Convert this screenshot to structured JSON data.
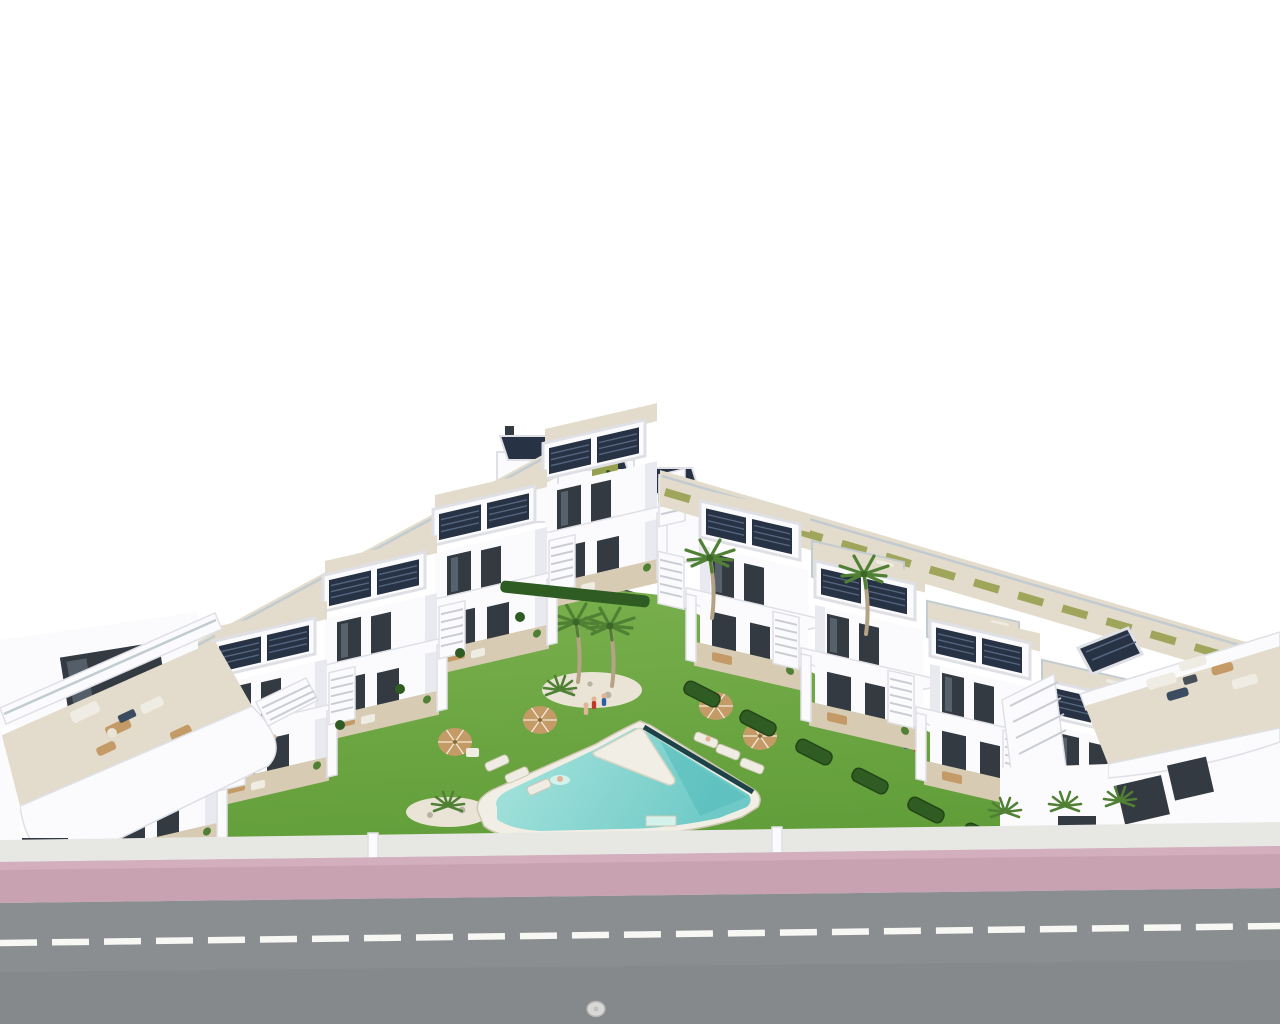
{
  "meta": {
    "title": "Aerial 3D architectural render of a white residential complex with communal pool and garden",
    "type": "3d-exterior-render",
    "canvas": {
      "width": 1280,
      "height": 1024
    }
  },
  "palette": {
    "sky": "#ffffff",
    "white": "#fbfbfd",
    "shade": "#e9eaef",
    "shade2": "#d9dade",
    "outline": "#dfe0e6",
    "window": "#343a42",
    "glass": "#73828f",
    "solar": "#273244",
    "solarline": "#55657f",
    "deck": "#e3dccc",
    "deckline": "#cfc6b2",
    "wood": "#d8cbb4",
    "tan": "#c49a66",
    "sofa": "#efece4",
    "navy": "#3c4c60",
    "lawn_light": "#7cb24f",
    "lawn_dark": "#5f9c38",
    "hedge": "#2f5c22",
    "olive": "#97a050",
    "palm": "#4f8034",
    "trunk": "#b5a386",
    "rock": "#e9e4d6",
    "rockdot": "#b9b3a4",
    "pooldeck": "#f1eee5",
    "water_light": "#a9e4dd",
    "water_mid": "#6fcac7",
    "water3": "#52bcba",
    "edge": "#1d4247",
    "splash": "#d4f2ec",
    "wall": "#e7e7e4",
    "pink": "#c9a2b2",
    "pink2": "#d6b3c1",
    "road": "#8b8e90",
    "roaddark": "#7f8284",
    "lane": "#f7f7f4",
    "skin": "#e2b394",
    "red": "#c0392b",
    "blue": "#2e5fa3",
    "stepline": "#c9ccd3",
    "glassline": "#c2cbd0",
    "table": "#474f58",
    "manhole": "#d8d8d6",
    "manholering": "#b3b3b1"
  },
  "scene": {
    "sky": {
      "label": "blank white sky background"
    },
    "complex": {
      "label": "U-shaped complex of modern white two-storey townhouses seen from above",
      "left_wing_units": 5,
      "right_wing_units": 4,
      "back_row_units": 3,
      "corner_buildings": 2,
      "solar_pergolas": 14,
      "features": [
        "rooftop solar panels on white pergolas",
        "curved white balcony fascias",
        "dark vertical window strips",
        "white exterior staircases",
        "roof terraces with outdoor furniture",
        "green vertical-garden panels on back row"
      ]
    },
    "courtyard": {
      "label": "communal landscaped garden between the wings",
      "lawn": "bright green lawn",
      "palm_trees_tall": 4,
      "palm_bushes": 3,
      "rock_gardens": 2,
      "parasols": 4,
      "sun_loungers": 6,
      "hedge_segments": 8,
      "pool": {
        "label": "freeform communal swimming pool with white triangular deck wedge and dark infinity edge",
        "swimmers": 1,
        "bottom_step_notch": 1
      },
      "people_on_lawn": 5,
      "people_on_terraces": 4
    },
    "street": {
      "boundary_wall": "low light-grey perimeter wall",
      "sidewalk": "pink paved sidewalk strip",
      "road": "grey asphalt road",
      "lane_marking": "white dashed centre line",
      "manholes": 1
    }
  }
}
